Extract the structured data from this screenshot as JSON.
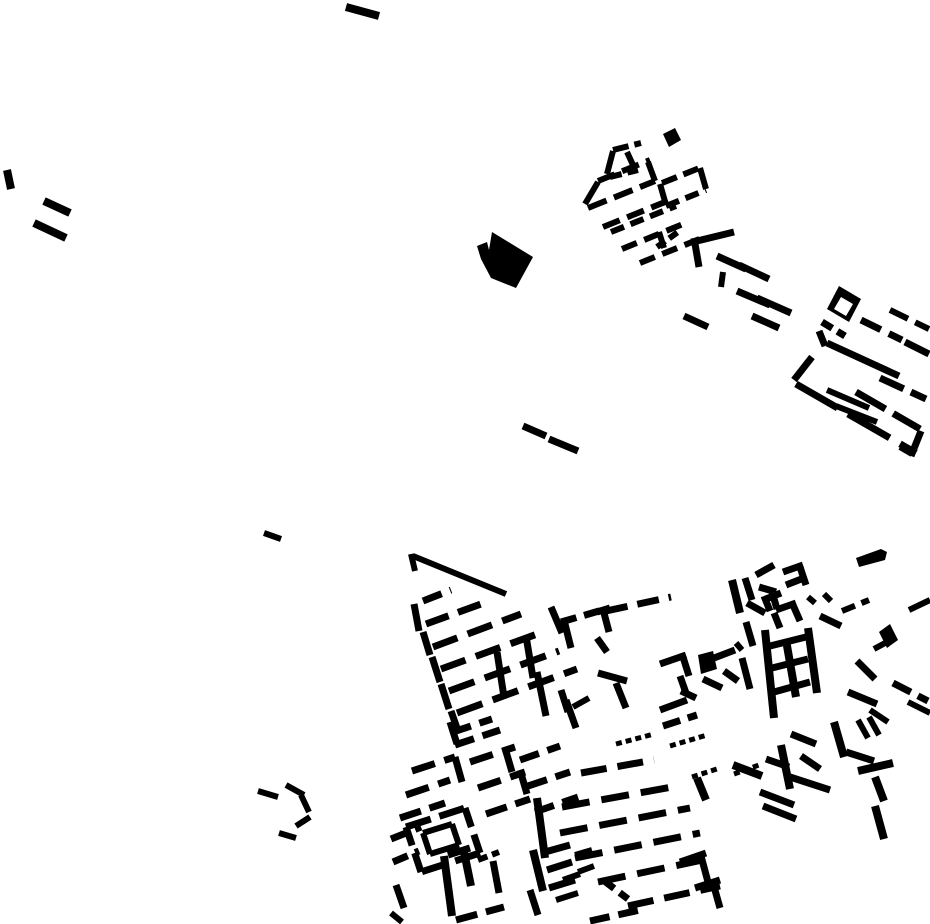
{
  "canvas": {
    "width": 930,
    "height": 924,
    "background_color": "#ffffff",
    "ink_color": "#000000",
    "kind": "building-footprint-site-plan"
  },
  "map": {
    "polygons": [
      {
        "name": "large-solid-building",
        "fill": "#000000",
        "points": "492,232 533,257 516,288 491,278 481,259 477,246 487,242 489,250"
      },
      {
        "name": "small-solid-square-north",
        "fill": "#000000",
        "points": "663,134 675,128 681,140 669,147"
      },
      {
        "name": "solid-courtyard-building",
        "fill": "#000000",
        "points": "839,286 861,299 849,322 827,309"
      },
      {
        "name": "solid-courtyard-building-court",
        "fill": "#ffffff",
        "points": "841,297 853,304 846,316 834,309"
      },
      {
        "name": "central-solid-square",
        "fill": "#000000",
        "points": "698,655 713,651 717,669 701,674"
      },
      {
        "name": "small-solid-parallelogram-east",
        "fill": "#000000",
        "points": "879,632 890,624 898,640 887,648"
      },
      {
        "name": "thick-bar-northeast",
        "fill": "#000000",
        "points": "856,558 881,549 887,552 885,560 859,567"
      }
    ],
    "segments": [
      [
        346,
        7,
        379,
        16,
        8
      ],
      [
        7,
        170,
        11,
        189,
        8
      ],
      [
        44,
        201,
        70,
        213,
        8
      ],
      [
        34,
        223,
        66,
        238,
        8
      ],
      [
        264,
        533,
        281,
        539,
        6
      ],
      [
        523,
        426,
        546,
        436,
        7
      ],
      [
        549,
        439,
        578,
        451,
        7
      ],
      [
        613,
        150,
        641,
        143,
        6,
        "16 6"
      ],
      [
        607,
        174,
        613,
        151,
        6
      ],
      [
        610,
        177,
        638,
        170,
        6,
        "12 6"
      ],
      [
        627,
        152,
        633,
        165,
        6
      ],
      [
        598,
        181,
        650,
        160,
        6,
        "18 8"
      ],
      [
        585,
        204,
        598,
        182,
        6
      ],
      [
        588,
        208,
        655,
        181,
        6,
        "20 8"
      ],
      [
        648,
        162,
        655,
        181,
        6
      ],
      [
        603,
        227,
        670,
        200,
        6,
        "18 8"
      ],
      [
        611,
        232,
        676,
        206,
        6,
        "14 7"
      ],
      [
        662,
        183,
        702,
        167,
        6,
        "16 7"
      ],
      [
        666,
        206,
        706,
        190,
        6,
        "14 7"
      ],
      [
        660,
        184,
        666,
        205,
        6
      ],
      [
        700,
        168,
        706,
        189,
        6
      ],
      [
        622,
        249,
        688,
        222,
        6,
        "16 8"
      ],
      [
        640,
        263,
        702,
        238,
        6,
        "16 8"
      ],
      [
        657,
        247,
        678,
        232,
        6,
        "10 5"
      ],
      [
        659,
        232,
        664,
        248,
        6
      ],
      [
        694,
        238,
        699,
        267,
        7
      ],
      [
        697,
        241,
        734,
        232,
        7
      ],
      [
        717,
        256,
        746,
        269,
        7
      ],
      [
        739,
        265,
        769,
        279,
        7
      ],
      [
        723,
        272,
        721,
        287,
        6
      ],
      [
        737,
        291,
        770,
        305,
        7
      ],
      [
        757,
        298,
        791,
        313,
        7
      ],
      [
        752,
        316,
        779,
        328,
        7
      ],
      [
        684,
        316,
        708,
        327,
        7
      ],
      [
        822,
        322,
        845,
        336,
        7,
        "12 6"
      ],
      [
        861,
        320,
        902,
        340,
        7,
        "22 9"
      ],
      [
        890,
        310,
        929,
        329,
        6,
        "20 8"
      ],
      [
        905,
        342,
        929,
        354,
        7
      ],
      [
        819,
        331,
        825,
        346,
        7
      ],
      [
        827,
        343,
        899,
        376,
        7
      ],
      [
        880,
        378,
        926,
        399,
        7,
        "26 8"
      ],
      [
        812,
        357,
        794,
        380,
        7
      ],
      [
        796,
        384,
        916,
        453,
        7,
        "48 12"
      ],
      [
        827,
        390,
        869,
        408,
        6
      ],
      [
        836,
        406,
        877,
        422,
        6
      ],
      [
        856,
        392,
        920,
        429,
        7,
        "34 9"
      ],
      [
        921,
        431,
        911,
        456,
        7
      ],
      [
        900,
        447,
        912,
        454,
        6
      ],
      [
        413,
        556,
        506,
        594,
        6
      ],
      [
        411,
        554,
        415,
        571,
        6
      ],
      [
        414,
        604,
        419,
        631,
        7
      ],
      [
        423,
        632,
        430,
        655,
        7
      ],
      [
        432,
        657,
        440,
        682,
        7
      ],
      [
        441,
        684,
        449,
        709,
        7
      ],
      [
        451,
        711,
        458,
        731,
        7
      ],
      [
        423,
        601,
        451,
        590,
        7,
        "20 9"
      ],
      [
        426,
        624,
        481,
        604,
        7,
        "24 10"
      ],
      [
        433,
        647,
        521,
        614,
        7,
        "26 11"
      ],
      [
        441,
        669,
        540,
        633,
        7,
        "26 11"
      ],
      [
        449,
        691,
        559,
        651,
        7,
        "27 11"
      ],
      [
        457,
        713,
        577,
        669,
        7,
        "27 11"
      ],
      [
        497,
        652,
        504,
        697,
        7
      ],
      [
        526,
        636,
        533,
        678,
        7
      ],
      [
        537,
        672,
        546,
        716,
        7
      ],
      [
        551,
        607,
        562,
        633,
        7
      ],
      [
        566,
        700,
        576,
        728,
        7
      ],
      [
        606,
        611,
        671,
        597,
        7,
        "22 10"
      ],
      [
        597,
        612,
        610,
        608,
        7
      ],
      [
        604,
        613,
        609,
        632,
        7
      ],
      [
        561,
        622,
        606,
        609,
        7,
        "16 8"
      ],
      [
        564,
        620,
        571,
        648,
        7
      ],
      [
        561,
        690,
        568,
        712,
        7
      ],
      [
        573,
        707,
        589,
        698,
        6
      ],
      [
        597,
        638,
        607,
        652,
        7
      ],
      [
        598,
        673,
        627,
        681,
        7
      ],
      [
        616,
        683,
        626,
        708,
        7
      ],
      [
        660,
        664,
        686,
        655,
        7
      ],
      [
        683,
        657,
        689,
        676,
        7
      ],
      [
        680,
        676,
        686,
        693,
        7
      ],
      [
        681,
        691,
        696,
        698,
        7
      ],
      [
        660,
        710,
        687,
        700,
        7
      ],
      [
        663,
        726,
        697,
        715,
        7,
        "18 8"
      ],
      [
        714,
        658,
        735,
        650,
        7
      ],
      [
        736,
        643,
        742,
        650,
        6
      ],
      [
        732,
        580,
        740,
        613,
        8
      ],
      [
        759,
        587,
        776,
        592,
        7
      ],
      [
        772,
        592,
        777,
        609,
        7
      ],
      [
        746,
        622,
        753,
        646,
        7
      ],
      [
        742,
        658,
        750,
        689,
        7
      ],
      [
        703,
        679,
        722,
        688,
        7
      ],
      [
        724,
        671,
        738,
        681,
        7
      ],
      [
        765,
        630,
        774,
        718,
        8
      ],
      [
        786,
        640,
        796,
        697,
        8
      ],
      [
        808,
        628,
        817,
        693,
        8
      ],
      [
        770,
        646,
        806,
        637,
        7
      ],
      [
        772,
        668,
        808,
        659,
        7
      ],
      [
        774,
        692,
        810,
        682,
        7
      ],
      [
        783,
        572,
        803,
        565,
        7
      ],
      [
        800,
        567,
        806,
        585,
        7
      ],
      [
        786,
        585,
        804,
        578,
        7
      ],
      [
        766,
        599,
        781,
        593,
        7
      ],
      [
        764,
        596,
        770,
        611,
        7
      ],
      [
        776,
        610,
        796,
        603,
        7
      ],
      [
        793,
        605,
        800,
        621,
        7
      ],
      [
        774,
        613,
        780,
        628,
        7
      ],
      [
        808,
        597,
        815,
        603,
        6
      ],
      [
        824,
        594,
        831,
        601,
        6
      ],
      [
        820,
        616,
        841,
        626,
        7
      ],
      [
        745,
        578,
        752,
        600,
        7
      ],
      [
        747,
        603,
        765,
        613,
        7
      ],
      [
        756,
        575,
        774,
        565,
        7
      ],
      [
        842,
        611,
        869,
        600,
        6,
        "14 7"
      ],
      [
        848,
        692,
        877,
        704,
        7
      ],
      [
        870,
        710,
        888,
        722,
        6
      ],
      [
        893,
        683,
        928,
        701,
        7,
        "20 8"
      ],
      [
        908,
        702,
        930,
        713,
        6
      ],
      [
        909,
        610,
        930,
        600,
        6
      ],
      [
        857,
        661,
        875,
        679,
        7
      ],
      [
        874,
        649,
        887,
        642,
        6
      ],
      [
        412,
        771,
        455,
        757,
        7,
        "24 10"
      ],
      [
        406,
        795,
        450,
        780,
        7,
        "24 10"
      ],
      [
        400,
        818,
        445,
        803,
        7,
        "22 9"
      ],
      [
        391,
        839,
        421,
        827,
        7,
        "18 8"
      ],
      [
        393,
        862,
        419,
        851,
        7,
        "16 8"
      ],
      [
        450,
        733,
        492,
        719,
        7,
        "22 9"
      ],
      [
        450,
        722,
        457,
        744,
        7
      ],
      [
        455,
        745,
        500,
        730,
        7,
        "20 9"
      ],
      [
        470,
        762,
        515,
        747,
        7,
        "24 10"
      ],
      [
        478,
        788,
        525,
        772,
        7,
        "24 10"
      ],
      [
        505,
        748,
        512,
        772,
        7
      ],
      [
        520,
        760,
        560,
        746,
        7,
        "20 9"
      ],
      [
        528,
        786,
        570,
        772,
        7,
        "20 9"
      ],
      [
        535,
        812,
        578,
        797,
        7,
        "20 9"
      ],
      [
        486,
        814,
        530,
        799,
        7,
        "22 9"
      ],
      [
        455,
        757,
        462,
        782,
        7
      ],
      [
        520,
        770,
        527,
        794,
        7
      ],
      [
        406,
        827,
        465,
        808,
        7,
        "26 9"
      ],
      [
        465,
        808,
        480,
        853,
        7,
        "20 8"
      ],
      [
        480,
        853,
        421,
        872,
        7,
        "26 9"
      ],
      [
        421,
        872,
        406,
        827,
        7,
        "20 8"
      ],
      [
        423,
        833,
        452,
        824,
        6
      ],
      [
        452,
        824,
        459,
        845,
        6
      ],
      [
        459,
        845,
        430,
        854,
        6
      ],
      [
        430,
        854,
        423,
        833,
        6
      ],
      [
        444,
        856,
        452,
        916,
        8
      ],
      [
        464,
        852,
        471,
        886,
        8
      ],
      [
        448,
        855,
        470,
        848,
        7
      ],
      [
        493,
        861,
        499,
        893,
        7
      ],
      [
        478,
        860,
        499,
        852,
        6,
        "10 5"
      ],
      [
        396,
        885,
        404,
        908,
        7
      ],
      [
        391,
        913,
        402,
        922,
        6
      ],
      [
        581,
        773,
        654,
        760,
        7,
        "26 11"
      ],
      [
        562,
        807,
        672,
        787,
        7,
        "28 12"
      ],
      [
        560,
        833,
        690,
        808,
        7,
        "28 12"
      ],
      [
        575,
        858,
        700,
        833,
        7,
        "28 12"
      ],
      [
        598,
        882,
        712,
        858,
        7,
        "28 12"
      ],
      [
        628,
        906,
        720,
        886,
        7,
        "26 11"
      ],
      [
        590,
        921,
        640,
        910,
        7,
        "20 9"
      ],
      [
        456,
        920,
        504,
        907,
        7,
        "22 9"
      ],
      [
        603,
        880,
        628,
        899,
        7,
        "14 7"
      ],
      [
        616,
        744,
        654,
        734,
        5,
        "6 4"
      ],
      [
        670,
        746,
        707,
        735,
        5,
        "6 4"
      ],
      [
        692,
        777,
        720,
        768,
        5,
        "6 4"
      ],
      [
        734,
        774,
        759,
        765,
        5,
        "6 4"
      ],
      [
        697,
        778,
        706,
        800,
        8
      ],
      [
        733,
        765,
        762,
        776,
        8
      ],
      [
        766,
        759,
        789,
        767,
        7
      ],
      [
        781,
        745,
        790,
        789,
        8
      ],
      [
        791,
        734,
        816,
        744,
        7
      ],
      [
        801,
        756,
        820,
        769,
        7
      ],
      [
        790,
        777,
        830,
        790,
        7
      ],
      [
        760,
        792,
        794,
        805,
        7
      ],
      [
        763,
        806,
        796,
        819,
        7
      ],
      [
        834,
        722,
        844,
        757,
        8
      ],
      [
        846,
        752,
        874,
        761,
        7
      ],
      [
        858,
        720,
        868,
        738,
        6
      ],
      [
        869,
        717,
        879,
        735,
        6
      ],
      [
        858,
        771,
        893,
        763,
        8
      ],
      [
        875,
        777,
        884,
        801,
        8
      ],
      [
        875,
        806,
        884,
        839,
        8
      ],
      [
        680,
        862,
        706,
        853,
        7
      ],
      [
        701,
        856,
        708,
        882,
        7
      ],
      [
        695,
        888,
        720,
        880,
        7
      ],
      [
        713,
        883,
        720,
        908,
        7
      ],
      [
        258,
        791,
        278,
        797,
        6
      ],
      [
        286,
        785,
        304,
        795,
        6
      ],
      [
        301,
        795,
        309,
        812,
        6
      ],
      [
        279,
        833,
        296,
        838,
        6
      ],
      [
        296,
        826,
        310,
        817,
        6
      ],
      [
        533,
        850,
        543,
        891,
        8
      ],
      [
        537,
        798,
        545,
        858,
        8
      ],
      [
        545,
        852,
        570,
        845,
        7
      ],
      [
        547,
        870,
        572,
        862,
        7
      ],
      [
        549,
        888,
        575,
        880,
        7
      ],
      [
        575,
        855,
        592,
        850,
        6
      ],
      [
        578,
        872,
        594,
        866,
        6
      ],
      [
        563,
        880,
        580,
        874,
        6
      ],
      [
        530,
        890,
        538,
        915,
        7
      ],
      [
        556,
        900,
        578,
        893,
        6
      ]
    ]
  }
}
